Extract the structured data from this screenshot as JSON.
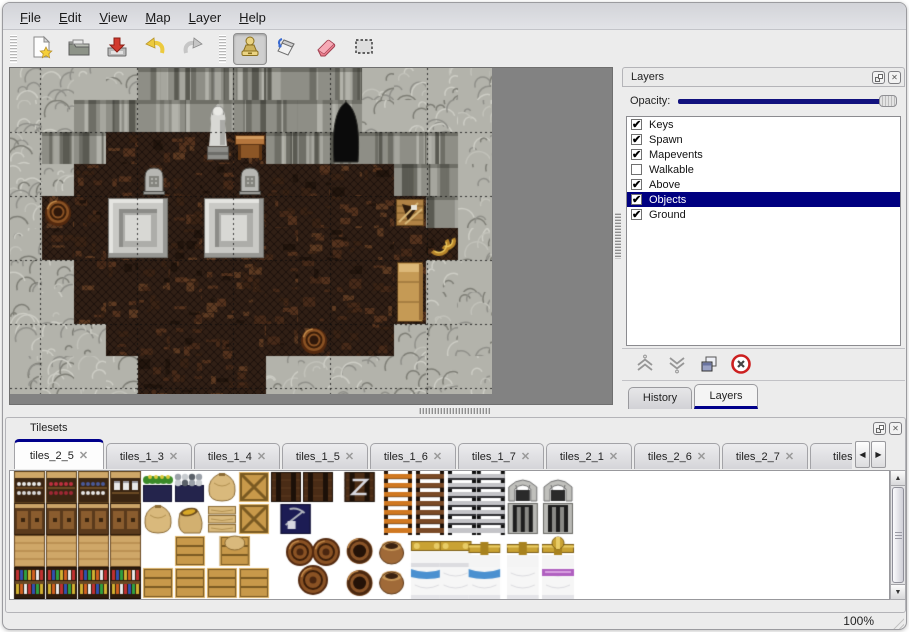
{
  "menu": {
    "items": [
      "File",
      "Edit",
      "View",
      "Map",
      "Layer",
      "Help"
    ]
  },
  "toolbar": {
    "buttons": [
      "new",
      "open",
      "save",
      "undo",
      "redo",
      "stamp",
      "fill",
      "eraser",
      "select"
    ],
    "selected_tool": "stamp"
  },
  "icons": {
    "check": "✔",
    "close": "✕",
    "scroll_left": "◀",
    "scroll_right": "▶",
    "up": "▲",
    "down": "▼"
  },
  "colors": {
    "selection_navy": "#000080",
    "tab_accent": "#00008b",
    "window_bg": "#ececec",
    "map_bg": "#828282",
    "eraser_pink": "#e87888"
  },
  "map": {
    "tile_size": 32,
    "legend": {
      "L": "rock-ground",
      "W": "rock-wall",
      "F": "wood-floor"
    },
    "grid": [
      "LLLLWWWWWWWLLLL",
      "LLWWWWWWWWWLLLL",
      "LWWFFFFFWWWWWWL",
      "LLFFFFFFFFFFWWL",
      "LFFFFFFFFFFFFWL",
      "LFFFFFFFFFFFFFL",
      "LLFFFFFFFFFFFLL",
      "LLFFFFFFFFFFFLL",
      "LLLFFFFFFFFFLLL",
      "LLLLFFFFLLLLLLL"
    ],
    "objects": [
      {
        "type": "statue",
        "col": 6,
        "row": 1,
        "w": 1,
        "h": 2
      },
      {
        "type": "table",
        "col": 7,
        "row": 2,
        "w": 1,
        "h": 1
      },
      {
        "type": "cave",
        "col": 10,
        "row": 1,
        "w": 1,
        "h": 2
      },
      {
        "type": "gravestone",
        "col": 4,
        "row": 3,
        "w": 1,
        "h": 1
      },
      {
        "type": "gravestone",
        "col": 7,
        "row": 3,
        "w": 1,
        "h": 1
      },
      {
        "type": "pedestal",
        "col": 3,
        "row": 4,
        "w": 2,
        "h": 2
      },
      {
        "type": "pedestal",
        "col": 6,
        "row": 4,
        "w": 2,
        "h": 2
      },
      {
        "type": "barrel",
        "col": 1,
        "row": 4,
        "w": 1,
        "h": 1
      },
      {
        "type": "broken-crate",
        "col": 12,
        "row": 4,
        "w": 1,
        "h": 1
      },
      {
        "type": "horns",
        "col": 13,
        "row": 5,
        "w": 1,
        "h": 1
      },
      {
        "type": "cabinet",
        "col": 12,
        "row": 6,
        "w": 1,
        "h": 2
      },
      {
        "type": "barrel",
        "col": 9,
        "row": 8,
        "w": 1,
        "h": 1
      }
    ]
  },
  "layers_panel": {
    "title": "Layers",
    "opacity_label": "Opacity:",
    "opacity_fraction": 1,
    "layers": [
      {
        "label": "Keys",
        "checked": true,
        "selected": false
      },
      {
        "label": "Spawn",
        "checked": true,
        "selected": false
      },
      {
        "label": "Mapevents",
        "checked": true,
        "selected": false
      },
      {
        "label": "Walkable",
        "checked": false,
        "selected": false
      },
      {
        "label": "Above",
        "checked": true,
        "selected": false
      },
      {
        "label": "Objects",
        "checked": true,
        "selected": true
      },
      {
        "label": "Ground",
        "checked": true,
        "selected": false
      }
    ],
    "actions": [
      "raise-layer",
      "lower-layer",
      "duplicate-layer",
      "delete-layer"
    ],
    "tabs": [
      {
        "label": "History",
        "active": false
      },
      {
        "label": "Layers",
        "active": true
      }
    ]
  },
  "tilesets_panel": {
    "title": "Tilesets",
    "tabs": [
      {
        "label": "tiles_2_5",
        "active": true
      },
      {
        "label": "tiles_1_3",
        "active": false
      },
      {
        "label": "tiles_1_4",
        "active": false
      },
      {
        "label": "tiles_1_5",
        "active": false
      },
      {
        "label": "tiles_1_6",
        "active": false
      },
      {
        "label": "tiles_1_7",
        "active": false
      },
      {
        "label": "tiles_2_1",
        "active": false
      },
      {
        "label": "tiles_2_6",
        "active": false
      },
      {
        "label": "tiles_2_7",
        "active": false
      },
      {
        "label": "tiles_",
        "active": false
      }
    ],
    "tiles": [
      {
        "t": "shelf_dishes",
        "c": 0,
        "r": 0
      },
      {
        "t": "shelf_red",
        "c": 1,
        "r": 0
      },
      {
        "t": "shelf_blue",
        "c": 2,
        "r": 0
      },
      {
        "t": "shelf_jars",
        "c": 3,
        "r": 0
      },
      {
        "t": "plant_box",
        "c": 4,
        "r": 0
      },
      {
        "t": "coal_box",
        "c": 5,
        "r": 0
      },
      {
        "t": "sack",
        "c": 6,
        "r": 0
      },
      {
        "t": "crate_x",
        "c": 7,
        "r": 0
      },
      {
        "t": "crate_dark",
        "c": 8,
        "r": 0
      },
      {
        "t": "crate_dark",
        "c": 9,
        "r": 0
      },
      {
        "t": "crate_mark",
        "c": 10.3,
        "r": 0
      },
      {
        "t": "ladder_orange",
        "c": 11.5,
        "r": 0,
        "h": 2
      },
      {
        "t": "ladder_brown",
        "c": 12.5,
        "r": 0,
        "h": 2
      },
      {
        "t": "ladder_gray",
        "c": 13.5,
        "r": 0,
        "h": 2
      },
      {
        "t": "ladder_gray",
        "c": 14.4,
        "r": 0,
        "h": 2
      },
      {
        "t": "arch",
        "c": 15.4,
        "r": 0
      },
      {
        "t": "arch",
        "c": 16.5,
        "r": 0
      },
      {
        "t": "shelf_drawer",
        "c": 0,
        "r": 1
      },
      {
        "t": "shelf_drawer",
        "c": 1,
        "r": 1
      },
      {
        "t": "shelf_drawer",
        "c": 2,
        "r": 1
      },
      {
        "t": "shelf_drawer",
        "c": 3,
        "r": 1
      },
      {
        "t": "sack",
        "c": 4,
        "r": 1
      },
      {
        "t": "sack_open",
        "c": 5,
        "r": 1
      },
      {
        "t": "sack_stack",
        "c": 6,
        "r": 1
      },
      {
        "t": "crate_x",
        "c": 7,
        "r": 1
      },
      {
        "t": "crate_navy",
        "c": 8.3,
        "r": 1
      },
      {
        "t": "door",
        "c": 15.4,
        "r": 1
      },
      {
        "t": "door",
        "c": 16.5,
        "r": 1
      },
      {
        "t": "shelf_wood_top",
        "c": 0,
        "r": 2
      },
      {
        "t": "shelf_wood_top",
        "c": 1,
        "r": 2
      },
      {
        "t": "shelf_wood_top",
        "c": 2,
        "r": 2
      },
      {
        "t": "shelf_wood_top",
        "c": 3,
        "r": 2
      },
      {
        "t": "crate",
        "c": 5,
        "r": 2
      },
      {
        "t": "sack_crate",
        "c": 6.4,
        "r": 2
      },
      {
        "t": "barrels",
        "c": 8.5,
        "r": 2,
        "w": 1.7,
        "h": 2
      },
      {
        "t": "barrel_top",
        "c": 10.3,
        "r": 2
      },
      {
        "t": "pots",
        "c": 11.3,
        "r": 2,
        "h": 2
      },
      {
        "t": "bed_head",
        "c": 12.4,
        "r": 2
      },
      {
        "t": "bed_head",
        "c": 13.3,
        "r": 2
      },
      {
        "t": "pipe",
        "c": 14.2,
        "r": 2
      },
      {
        "t": "pipe",
        "c": 15.4,
        "r": 2
      },
      {
        "t": "pipe_valve",
        "c": 16.5,
        "r": 2
      },
      {
        "t": "shelf_books",
        "c": 0,
        "r": 3
      },
      {
        "t": "shelf_books",
        "c": 1,
        "r": 3
      },
      {
        "t": "shelf_books",
        "c": 2,
        "r": 3
      },
      {
        "t": "shelf_books",
        "c": 3,
        "r": 3
      },
      {
        "t": "crate",
        "c": 4,
        "r": 3
      },
      {
        "t": "crate",
        "c": 5,
        "r": 3
      },
      {
        "t": "crate",
        "c": 6,
        "r": 3
      },
      {
        "t": "crate",
        "c": 7,
        "r": 3
      },
      {
        "t": "barrel_top",
        "c": 10.3,
        "r": 3
      },
      {
        "t": "bed_blue",
        "c": 12.4,
        "r": 3
      },
      {
        "t": "bed_white",
        "c": 13.3,
        "r": 3
      },
      {
        "t": "bed_blue",
        "c": 14.2,
        "r": 3
      },
      {
        "t": "bed_white",
        "c": 15.4,
        "r": 3
      },
      {
        "t": "bed_purple",
        "c": 16.5,
        "r": 3
      }
    ]
  },
  "statusbar": {
    "zoom": "100%"
  }
}
